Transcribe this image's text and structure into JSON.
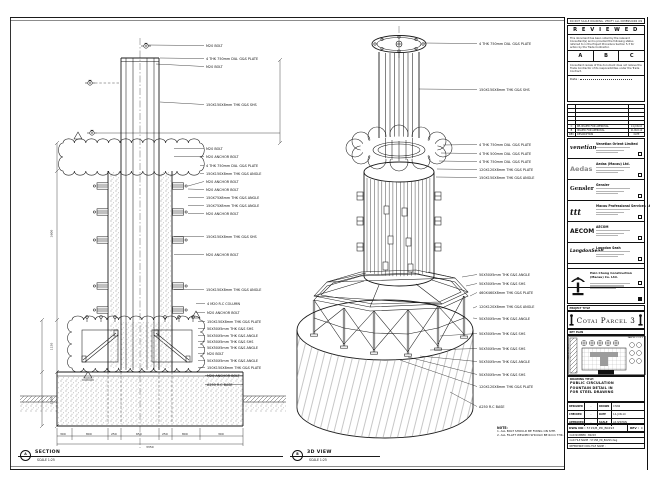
{
  "sheet": {
    "edge_note": "DO NOT SCALE DRAWING. VERIFY ALL DIMENSIONS ON SITE."
  },
  "section_view": {
    "bubble": "A",
    "title": "SECTION",
    "scale": "SCALE 1:25",
    "callouts": [
      "M20 BOLT",
      "4 THK 750mm DIA. G&S PLATE",
      "M20 BOLT",
      "150X150X8mm THK G&S SHS",
      "M20 BOLT",
      "M20 ANCHOR BOLT",
      "4 THK 750mm DIA. G&S PLATE",
      "150X150X8mm THK G&S ANGLE",
      "M20 ANCHOR BOLT",
      "M20 ANCHOR BOLT",
      "150X75X8mm THK G&S ANGLE",
      "150X75X8mm THK G&S ANGLE",
      "M20 ANCHOR BOLT",
      "150X150X8mm THK G&S SHS",
      "M20 ANCHOR BOLT",
      "150X150X8mm THK G&S ANGLE",
      "4 M20 R.C COLUMN",
      "M20 ANCHOR BOLT",
      "150X150X8mm THK G&S PLATE",
      "50X50X5mm THK G&S SHS",
      "50X50X5mm THK G&S ANGLE",
      "50X50X5mm THK G&S SHS",
      "50X50X5mm THK G&S ANGLE",
      "M20 BOLT",
      "50X50X5mm THK G&S ANGLE",
      "150X150X8mm THK G&S PLATE",
      "M20 ANCHOR BOLT",
      "A250 R.C BASE"
    ],
    "dims_bottom": [
      "300",
      "800",
      "250",
      "650",
      "250",
      "800",
      "300"
    ],
    "dim_total": "3350",
    "dims_left": [
      "3600",
      "1150",
      "1350"
    ]
  },
  "iso_view": {
    "bubble": "B",
    "title": "3D VIEW",
    "scale": "SCALE 1:25",
    "callouts": [
      "4 THK 750mm DIA. G&S PLATE",
      "150X150X8mm THK G&S SHS",
      "4 THK 750mm DIA. G&S PLATE",
      "4 THK 500mm DIA. G&S PLATE",
      "4 THK 750mm DIA. G&S PLATE",
      "120X120X8mm THK G&S PLATE",
      "150X150X8mm THK G&S ANGLE",
      "50X50X5mm THK G&S ANGLE",
      "50X50X5mm THK G&S SHS",
      "460X460X8mm THK G&S PLATE",
      "120X120X8mm THK G&S ANGLE",
      "50X50X5mm THK G&S ANGLE",
      "50X50X5mm THK G&S SHS",
      "50X50X5mm THK G&S SHS",
      "50X50X5mm THK G&S ANGLE",
      "50X50X5mm THK G&S SHS",
      "120X120X8mm THK G&S PLATE",
      "A250 R.C BASE"
    ]
  },
  "notes": {
    "heading": "NOTE:",
    "items": [
      "1. ALL BOLT SHOULD BE FIXING ON SITE.",
      "2. ALL FILLET WELDED SHOULD BE 6mm THK."
    ]
  },
  "titleblock": {
    "reviewed": {
      "title": "R E V I E W E D",
      "para1": "This document has been noted by the relevant Consultant(s) and is provided the following status referred to in the Project Procedure Section 5.3 for action by the Trade Contractor.",
      "options": [
        "A",
        "B",
        "C"
      ],
      "para2": "Consultant review of this document does not relieve the Trade Contractor of its responsibilities under the Trade Contract.",
      "date_label": "Date :"
    },
    "revisions": [
      {
        "rev": "C",
        "desc": "RE-ISSUED FOR APPROVAL",
        "date": "14-JUN-10"
      },
      {
        "rev": "B",
        "desc": "ISSUED FOR APPROVAL",
        "date": "21-MAY-10"
      },
      {
        "rev": "REV",
        "desc": "DESCRIPTION",
        "date": "DATE"
      }
    ],
    "companies": [
      {
        "logo": "venetian",
        "name": "Venetian Orient Limited"
      },
      {
        "logo": "Aedas",
        "name": "Aedas (Macau) Ltd."
      },
      {
        "logo": "Gensler",
        "name": "Gensler"
      },
      {
        "logo": "ttt",
        "name": "Macau Professional Services Ltd."
      },
      {
        "logo": "AECOM",
        "name": "AECOM"
      },
      {
        "logo": "LangdonSeah",
        "name": "Langdon Seah"
      }
    ],
    "contractor": {
      "name": "Hsin Chong Construction (Macau) Co. Ltd."
    },
    "project": {
      "label": "PROJECT TITLE",
      "name": "Cotai Parcel 3"
    },
    "keyplan": {
      "label": "KEY PLAN",
      "parcel1": "PARCEL 1 OF 3",
      "parcel2": "PARCEL 2 OF 3"
    },
    "drawing_title": {
      "label": "DRAWING TITLE:",
      "lines": [
        "PUBLIC CIRCULATION",
        "FOUNTAIN DETAIL IN",
        "FOR STEEL DRAWING"
      ]
    },
    "fields": {
      "designed_label": "DESIGNED",
      "designed": "-",
      "drawn_label": "DRAWN",
      "drawn": "CHAN",
      "checked_label": "CHECKED",
      "checked": "-",
      "date_label": "DATE",
      "date": "14-JUN-10",
      "approved_label": "APPROVED",
      "approved": "-",
      "scale_label": "SCALE",
      "scale": "AS SHOWN"
    },
    "dwg": {
      "label": "DWG NO :",
      "value": "5715/B_PD_B0293",
      "rev_label": "REV :",
      "rev": "C"
    },
    "cad": {
      "line1": "CAD NUMBER : B0293",
      "line2": "CAD FILE NAME : 5715B_PD_B0293.dwg",
      "line3": "REFERENCE DWG FILE NAME :"
    }
  }
}
